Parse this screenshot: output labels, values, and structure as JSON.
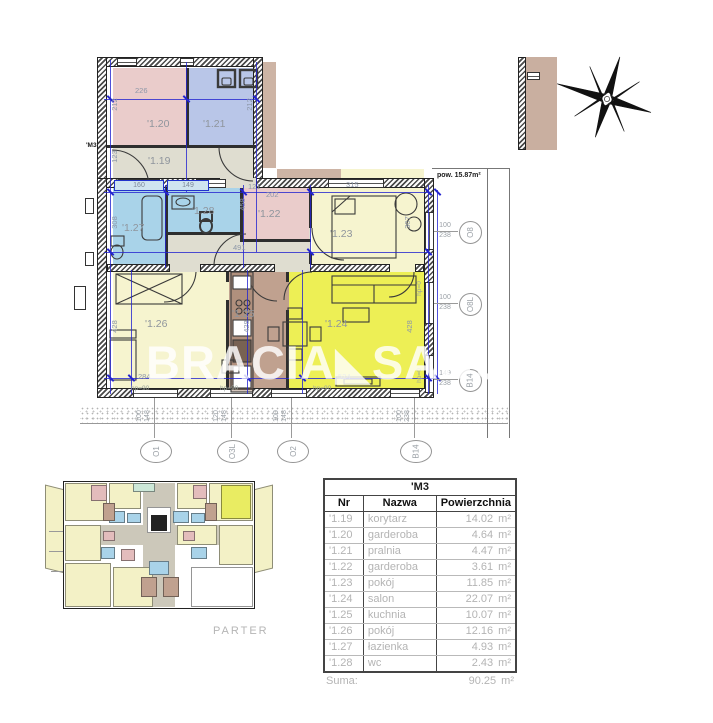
{
  "watermark": "BRACIA◣SADUR",
  "plan": {
    "unit_label": "'M3",
    "area_note": "pow. 15.87m²",
    "rooms": {
      "r119": {
        "label": "'1.19"
      },
      "r120": {
        "label": "'1.20"
      },
      "r121": {
        "label": "'1.21"
      },
      "r122": {
        "label": "'1.22"
      },
      "r123": {
        "label": "'1.23"
      },
      "r124": {
        "label": "'1.24"
      },
      "r125": {
        "label": "'1.25"
      },
      "r126": {
        "label": "'1.26"
      },
      "r127": {
        "label": "'1.27"
      },
      "r128": {
        "label": "'1.28"
      }
    },
    "dims": {
      "d226": "226",
      "d212a": "212",
      "d212b": "212",
      "d123": "123",
      "d160": "160",
      "d149": "149",
      "d121": "121",
      "d202": "202",
      "d315": "315",
      "d458": "458",
      "d308": "308",
      "d307": "307",
      "d491": "491",
      "d428a": "428",
      "d428b": "428",
      "d428c": "428",
      "d284": "284",
      "d524": "524",
      "hp90a": "hp=90",
      "hp90b": "hp=90",
      "hp90c": "hp=90",
      "hp0a": "hp=0",
      "hp0b": "hp=0"
    },
    "markers_right": {
      "r1": {
        "id": "O8",
        "a": "100",
        "b": "238"
      },
      "r2": {
        "id": "O8L",
        "a": "100",
        "b": "238"
      },
      "r3": {
        "id": "B14",
        "a": "149",
        "b": "238"
      }
    },
    "markers_bottom": {
      "b1": {
        "id": "O1",
        "a": "100",
        "b": "148"
      },
      "b2": {
        "id": "O3L",
        "a": "120",
        "b": "148"
      },
      "b3": {
        "id": "O2",
        "a": "100",
        "b": "148"
      },
      "b4": {
        "id": "B14",
        "a": "100",
        "b": "238"
      }
    }
  },
  "overview": {
    "caption": "PARTER"
  },
  "table": {
    "title": "'M3",
    "columns": [
      "Nr",
      "Nazwa",
      "Powierzchnia"
    ],
    "unit": "m²",
    "rows": [
      {
        "nr": "'1.19",
        "name": "korytarz",
        "area": "14.02"
      },
      {
        "nr": "'1.20",
        "name": "garderoba",
        "area": "4.64"
      },
      {
        "nr": "'1.21",
        "name": "pralnia",
        "area": "4.47"
      },
      {
        "nr": "'1.22",
        "name": "garderoba",
        "area": "3.61"
      },
      {
        "nr": "'1.23",
        "name": "pokój",
        "area": "11.85"
      },
      {
        "nr": "'1.24",
        "name": "salon",
        "area": "22.07"
      },
      {
        "nr": "'1.25",
        "name": "kuchnia",
        "area": "10.07"
      },
      {
        "nr": "'1.26",
        "name": "pokój",
        "area": "12.16"
      },
      {
        "nr": "'1.27",
        "name": "łazienka",
        "area": "4.93"
      },
      {
        "nr": "'1.28",
        "name": "wc",
        "area": "2.43"
      }
    ],
    "sum_label": "Suma:",
    "sum_value": "90.25"
  }
}
